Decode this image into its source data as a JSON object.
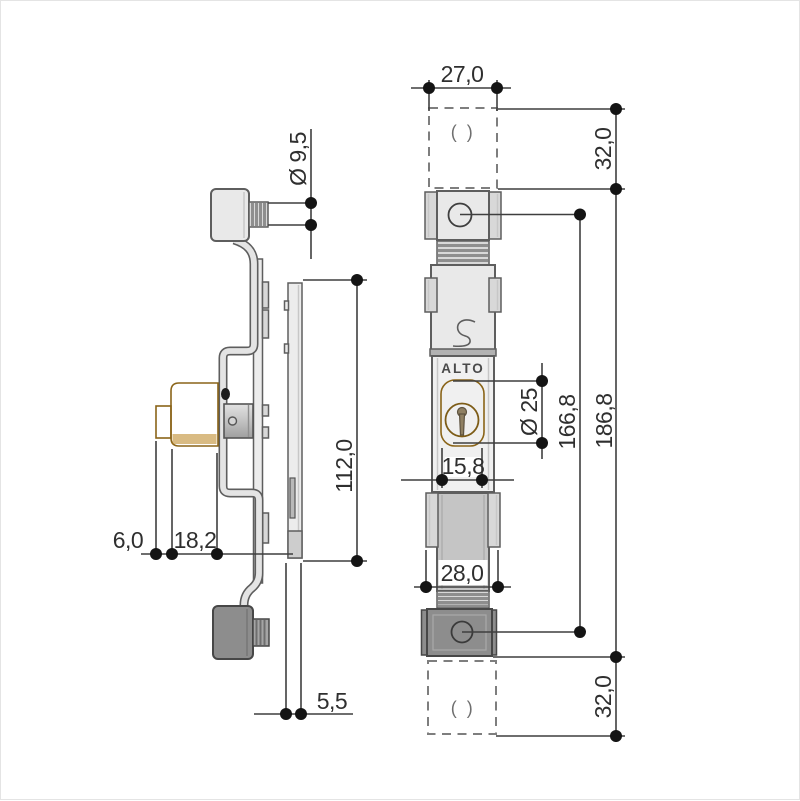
{
  "title": "ALTO espagnolette lock – dimensioned technical drawing",
  "brand": "ALTO",
  "slot_symbol": "( )",
  "dims": {
    "side": {
      "knob_diameter": "Ø 9,5",
      "plate_height": "112,0",
      "cylinder_step": "6,0",
      "cylinder_body": "18,2",
      "faceplate_thickness": "5,5"
    },
    "front": {
      "body_width": "27,0",
      "top_offset": "32,0",
      "total_length": "186,8",
      "hole_pitch": "166,8",
      "cylinder_diameter": "Ø 25",
      "cylinder_width": "15,8",
      "bolt_width": "28,0",
      "bottom_offset": "32,0"
    }
  },
  "colors": {
    "bg": "#ffffff",
    "frame": "#e4e4e4",
    "outline": "#5e5e5e",
    "outline-dark": "#474747",
    "body": "#e9e9e9",
    "case": "#f0f0f0",
    "rail": "#d8d8d8",
    "rib": "#8e8e8e",
    "bolt": "#c5c5c5",
    "divider": "#b2b2b2",
    "dark": "#8d8d8d",
    "plate": "#ececec",
    "bracket": "#e4e4e4",
    "yellow": "#e0a435",
    "yellow-dark": "#8a6418",
    "dim": "#3f3f3f",
    "dot": "#141414",
    "text": "#2f2f2f",
    "dash": "#7e7e7e",
    "paren": "#6f6f6f",
    "brand": "#4a4a4a"
  }
}
